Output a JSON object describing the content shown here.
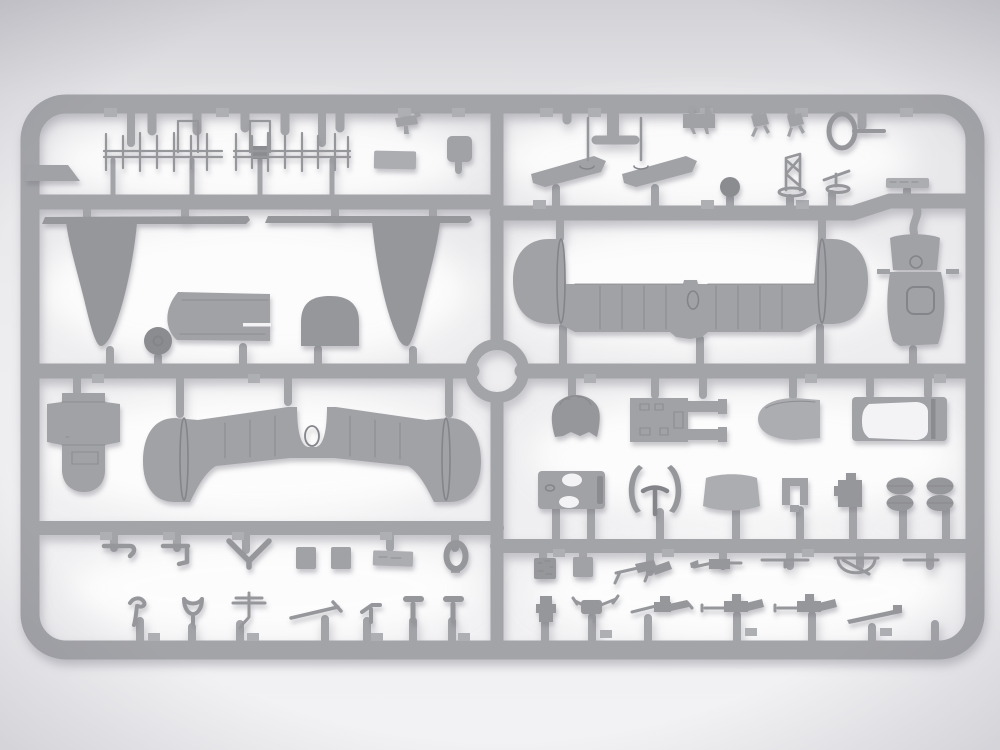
{
  "scene": {
    "type": "photograph",
    "subject": "injection-molded plastic model kit sprue (unpainted gray aircraft parts on a runner frame)",
    "orientation": "landscape",
    "visible_text": "none"
  },
  "colors": {
    "background_top": "#dddde0",
    "background_bottom": "#f2f2f4",
    "glow": "#ffffff",
    "runner": "#a3a4a8",
    "runner_light": "#aeafb3",
    "part": "#a1a2a6",
    "part_light": "#acadb1",
    "part_shade": "#96979b",
    "part_dark": "#8b8c90",
    "detail_line": "#84858a",
    "hole": "#f3f3f5",
    "shadow": "#777884"
  },
  "sprue": {
    "frame_shape": "rounded rectangle with center junction ring",
    "runner_rows": 5,
    "junction_ring_position": "center",
    "parts_inventory": [
      {
        "name": "antenna-array",
        "qty": 2
      },
      {
        "name": "clamp-bracket",
        "qty": 1
      },
      {
        "name": "equipment-canister",
        "qty": 1
      },
      {
        "name": "mounting-plate",
        "qty": 1
      },
      {
        "name": "edge-ramp",
        "qty": 1
      },
      {
        "name": "elevator-half-with-actuator",
        "qty": 2
      },
      {
        "name": "instrument-panel",
        "qty": 1
      },
      {
        "name": "rudder-pedal",
        "qty": 2
      },
      {
        "name": "loop-antenna",
        "qty": 1
      },
      {
        "name": "ball-fairing",
        "qty": 1
      },
      {
        "name": "truss-frame",
        "qty": 1
      },
      {
        "name": "control-lever",
        "qty": 1
      },
      {
        "name": "detail-strip",
        "qty": 1
      },
      {
        "name": "wing-strut-strip",
        "qty": 2
      },
      {
        "name": "propeller-blade",
        "qty": 2
      },
      {
        "name": "tailwheel",
        "qty": 1
      },
      {
        "name": "fuselage-deck-panel",
        "qty": 1
      },
      {
        "name": "cowl-dome",
        "qty": 1
      },
      {
        "name": "horizontal-stabilizer-section",
        "qty": 1
      },
      {
        "name": "cowl-top-box",
        "qty": 1
      },
      {
        "name": "cowl-side-panel",
        "qty": 1
      },
      {
        "name": "fuselage-nose-deck",
        "qty": 1
      },
      {
        "name": "lower-wing-center-section",
        "qty": 1
      },
      {
        "name": "headrest-fairing",
        "qty": 1
      },
      {
        "name": "engine-mount-frame",
        "qty": 1
      },
      {
        "name": "propeller-spinner",
        "qty": 1
      },
      {
        "name": "canopy-frame",
        "qty": 1
      },
      {
        "name": "bulkhead-plate-with-holes",
        "qty": 1
      },
      {
        "name": "bracket-pair-with-tee",
        "qty": 1
      },
      {
        "name": "curved-fairing-panel",
        "qty": 1
      },
      {
        "name": "u-channel-block",
        "qty": 1
      },
      {
        "name": "equipment-block",
        "qty": 1
      },
      {
        "name": "twin-oval-pair",
        "qty": 2
      },
      {
        "name": "hook-rod",
        "qty": 1
      },
      {
        "name": "angle-bracket",
        "qty": 1
      },
      {
        "name": "chevron-brace",
        "qty": 1
      },
      {
        "name": "cube-block",
        "qty": 2
      },
      {
        "name": "data-plate",
        "qty": 1
      },
      {
        "name": "oval-ring",
        "qty": 1
      },
      {
        "name": "curved-hook",
        "qty": 1
      },
      {
        "name": "v-cup",
        "qty": 1
      },
      {
        "name": "mast-with-yards",
        "qty": 1
      },
      {
        "name": "gun-barrel-rod",
        "qty": 1
      },
      {
        "name": "z-bracket",
        "qty": 1
      },
      {
        "name": "t-peg",
        "qty": 2
      },
      {
        "name": "radio-box",
        "qty": 1
      },
      {
        "name": "small-box",
        "qty": 1
      },
      {
        "name": "machine-gun",
        "qty": 3
      },
      {
        "name": "drum-gun",
        "qty": 1
      },
      {
        "name": "pitot-rod",
        "qty": 1
      },
      {
        "name": "gun-ring-mount",
        "qty": 1
      },
      {
        "name": "straight-rod",
        "qty": 1
      },
      {
        "name": "stacked-block",
        "qty": 1
      },
      {
        "name": "control-column",
        "qty": 1
      },
      {
        "name": "tapered-barrel",
        "qty": 1
      }
    ]
  }
}
